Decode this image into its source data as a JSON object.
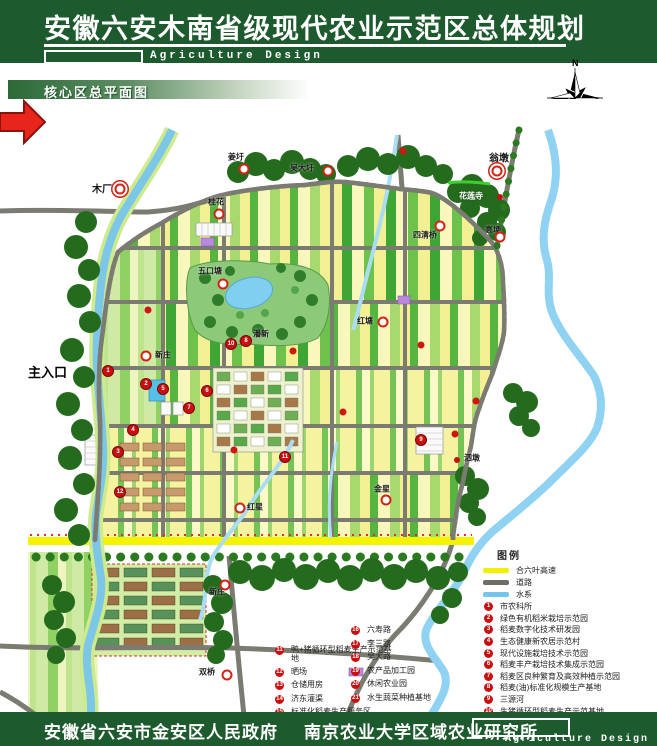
{
  "header": {
    "title": "安徽六安木南省级现代农业示范区总体规划",
    "subtitle": "Agriculture Design"
  },
  "section": {
    "label": "核心区总平面图"
  },
  "compass": {
    "north_label": "N"
  },
  "scalebar": {
    "labels": [
      "0",
      "1000",
      "3500m"
    ]
  },
  "map": {
    "entrance_label": "主入口",
    "places": [
      {
        "name": "木厂",
        "lx": 92,
        "ly": 188,
        "rx": 120,
        "ry": 189,
        "style": "big"
      },
      {
        "name": "姜圩",
        "lx": 228,
        "ly": 157,
        "rx": 244,
        "ry": 169,
        "style": "ring"
      },
      {
        "name": "吴大圩",
        "lx": 290,
        "ly": 168,
        "rx": 328,
        "ry": 171,
        "style": "ring"
      },
      {
        "name": "翁墩",
        "lx": 489,
        "ly": 157,
        "rx": 497,
        "ry": 171,
        "style": "big"
      },
      {
        "name": "花莲寺",
        "lx": 459,
        "ly": 196,
        "rx": 500,
        "ry": 197,
        "style": "sdot",
        "light": true
      },
      {
        "name": "高埂",
        "lx": 485,
        "ly": 230,
        "rx": 500,
        "ry": 237,
        "style": "ring"
      },
      {
        "name": "四清桥",
        "lx": 413,
        "ly": 235,
        "rx": 440,
        "ry": 226,
        "style": "ring"
      },
      {
        "name": "桂花",
        "lx": 208,
        "ly": 202,
        "rx": 219,
        "ry": 214,
        "style": "ring"
      },
      {
        "name": "五口塘",
        "lx": 198,
        "ly": 271,
        "rx": 223,
        "ry": 284,
        "style": "ring"
      },
      {
        "name": "潘新",
        "lx": 253,
        "ly": 334,
        "rx": 245,
        "ry": 341,
        "style": "ring"
      },
      {
        "name": "红塘",
        "lx": 357,
        "ly": 321,
        "rx": 383,
        "ry": 322,
        "style": "ring"
      },
      {
        "name": "新庄",
        "lx": 155,
        "ly": 355,
        "rx": 146,
        "ry": 356,
        "style": "ring"
      },
      {
        "name": "红星",
        "lx": 247,
        "ly": 507,
        "rx": 240,
        "ry": 508,
        "style": "ring"
      },
      {
        "name": "金星",
        "lx": 374,
        "ly": 489,
        "rx": 386,
        "ry": 500,
        "style": "ring"
      },
      {
        "name": "泗墩",
        "lx": 464,
        "ly": 458,
        "rx": 457,
        "ry": 460,
        "style": "sdot"
      },
      {
        "name": "新庄",
        "lx": 209,
        "ly": 592,
        "rx": 225,
        "ry": 585,
        "style": "ring"
      },
      {
        "name": "双桥",
        "lx": 199,
        "ly": 672,
        "rx": 227,
        "ry": 675,
        "style": "ring"
      }
    ],
    "numbered_markers": [
      {
        "n": 1,
        "x": 108,
        "y": 371
      },
      {
        "n": 2,
        "x": 146,
        "y": 384
      },
      {
        "n": 3,
        "x": 118,
        "y": 452
      },
      {
        "n": 4,
        "x": 133,
        "y": 430
      },
      {
        "n": 5,
        "x": 163,
        "y": 389
      },
      {
        "n": 6,
        "x": 207,
        "y": 391
      },
      {
        "n": 7,
        "x": 189,
        "y": 408
      },
      {
        "n": 8,
        "x": 246,
        "y": 341
      },
      {
        "n": 9,
        "x": 421,
        "y": 440
      },
      {
        "n": 10,
        "x": 231,
        "y": 344
      },
      {
        "n": 11,
        "x": 285,
        "y": 457
      },
      {
        "n": 12,
        "x": 120,
        "y": 492
      }
    ],
    "dots": [
      [
        148,
        310
      ],
      [
        293,
        351
      ],
      [
        343,
        412
      ],
      [
        421,
        345
      ],
      [
        455,
        434
      ],
      [
        476,
        401
      ],
      [
        403,
        151
      ],
      [
        234,
        450
      ]
    ]
  },
  "legend": {
    "title": "图例",
    "line_items": [
      {
        "label": "合六叶高速",
        "color": "#f2ef00"
      },
      {
        "label": "道路",
        "color": "#6e6e64"
      },
      {
        "label": "水系",
        "color": "#74c6ea"
      }
    ],
    "items": [
      "市农科所",
      "绿色有机稻米栽培示范园",
      "稻麦数字化技术研发园",
      "生态健康新农居示范村",
      "现代设施栽培技术示范园",
      "稻麦丰产栽培技术集成示范园",
      "稻麦区良种繁育及高效种植示范园",
      "稻麦(油)标准化规模生产基地",
      "三源河",
      "生猪循环型稻麦生产示范基地"
    ]
  },
  "legend2": {
    "left": [
      {
        "n": 11,
        "label": "鸭+猪循环型稻麦生产示范基地"
      },
      {
        "n": 12,
        "label": "晒场"
      },
      {
        "n": 13,
        "label": "仓储用房"
      },
      {
        "n": 14,
        "label": "济东灌渠"
      },
      {
        "n": 15,
        "label": "标准化稻麦生产服务区"
      }
    ],
    "right": [
      {
        "n": 16,
        "label": "六寿路"
      },
      {
        "n": 17,
        "label": "李三路"
      },
      {
        "n": 18,
        "label": "吴大路"
      },
      {
        "n": 19,
        "label": "农产品加工园"
      },
      {
        "n": 20,
        "label": "休闲农业园"
      },
      {
        "n": 21,
        "label": "水生蔬菜种植基地"
      }
    ]
  },
  "footer": {
    "org1": "安徽省六安市金安区人民政府",
    "org2": "南京农业大学区域农业研究所",
    "subtitle": "Agriculture Design"
  }
}
